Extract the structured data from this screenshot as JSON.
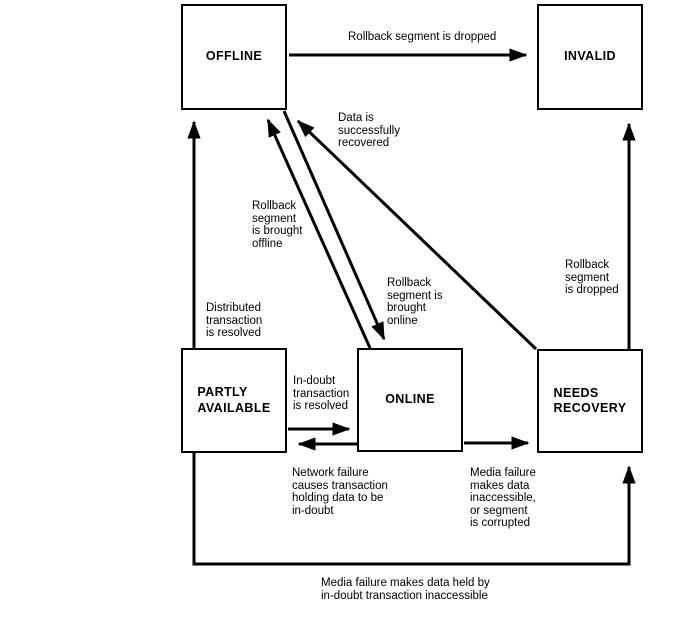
{
  "diagram": {
    "background_color": "#ffffff",
    "line_color": "#000000",
    "states": {
      "offline": "OFFLINE",
      "invalid": "INVALID",
      "partly_available": "PARTLY\nAVAILABLE",
      "online": "ONLINE",
      "needs_recovery": "NEEDS\nRECOVERY"
    },
    "transitions": {
      "rollback_dropped_top": "Rollback segment is dropped",
      "data_recovered": "Data is\nsuccessfully\nrecovered",
      "brought_offline": "Rollback\nsegment\nis brought\noffline",
      "brought_online": "Rollback\nsegment is\nbrought\nonline",
      "rollback_dropped_right": "Rollback\nsegment\nis dropped",
      "distributed_resolved": "Distributed\ntransaction\nis resolved",
      "indoubt_resolved": "In-doubt\ntransaction\nis resolved",
      "network_failure": "Network failure\ncauses transaction\nholding data to be\nin-doubt",
      "media_failure_segment": "Media failure\nmakes data\ninaccessible,\nor segment\nis corrupted",
      "media_failure_indoubt": "Media failure makes data held by\nin-doubt transaction inaccessible"
    }
  }
}
